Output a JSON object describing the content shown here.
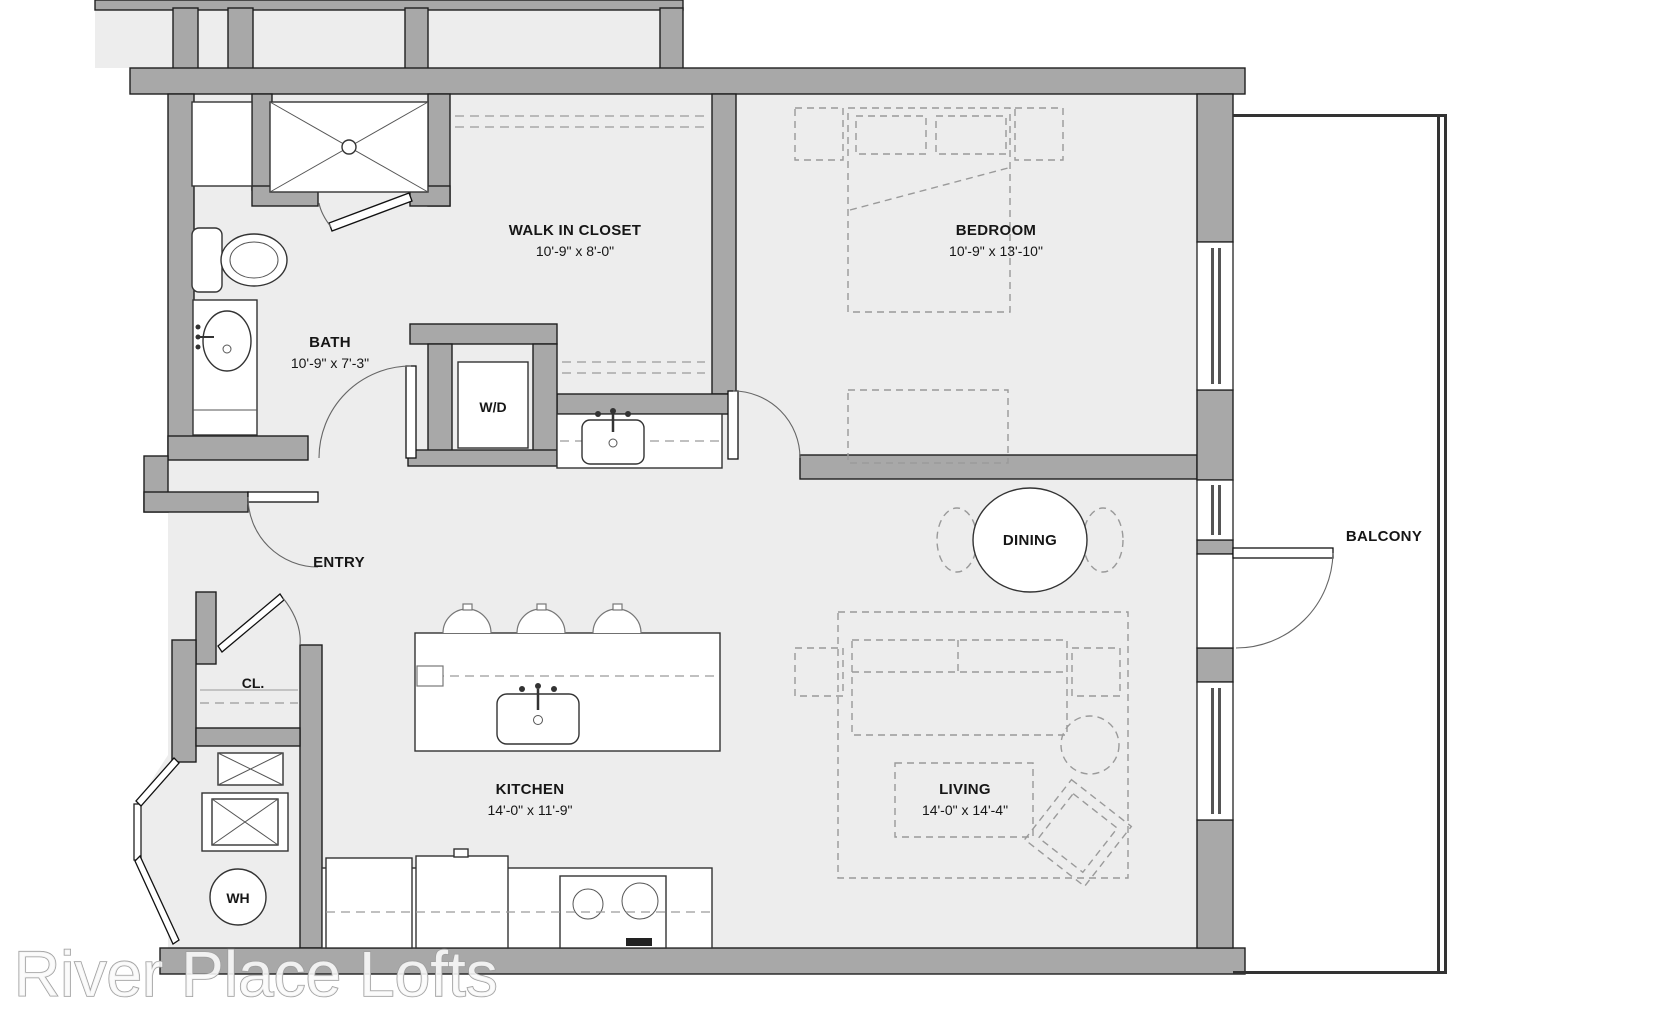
{
  "title": "River Place Lofts",
  "colors": {
    "wall": "#a8a8a8",
    "wall_outline": "#1f1f1f",
    "floor": "#ededed",
    "fixture_stroke": "#333333",
    "furniture_dash": "#9a9a9a",
    "background": "#ffffff"
  },
  "rooms": {
    "walk_in_closet": {
      "name": "WALK IN CLOSET",
      "dims": "10'-9\" x 8'-0\""
    },
    "bedroom": {
      "name": "BEDROOM",
      "dims": "10'-9\" x 13'-10\""
    },
    "bath": {
      "name": "BATH",
      "dims": "10'-9\" x 7'-3\""
    },
    "kitchen": {
      "name": "KITCHEN",
      "dims": "14'-0\" x 11'-9\""
    },
    "living": {
      "name": "LIVING",
      "dims": "14'-0\" x 14'-4\""
    },
    "dining": {
      "name": "DINING"
    },
    "entry": {
      "name": "ENTRY"
    },
    "balcony": {
      "name": "BALCONY"
    },
    "closet": {
      "name": "CL."
    },
    "laundry": {
      "name": "W/D"
    },
    "water_heater": {
      "name": "WH"
    }
  }
}
